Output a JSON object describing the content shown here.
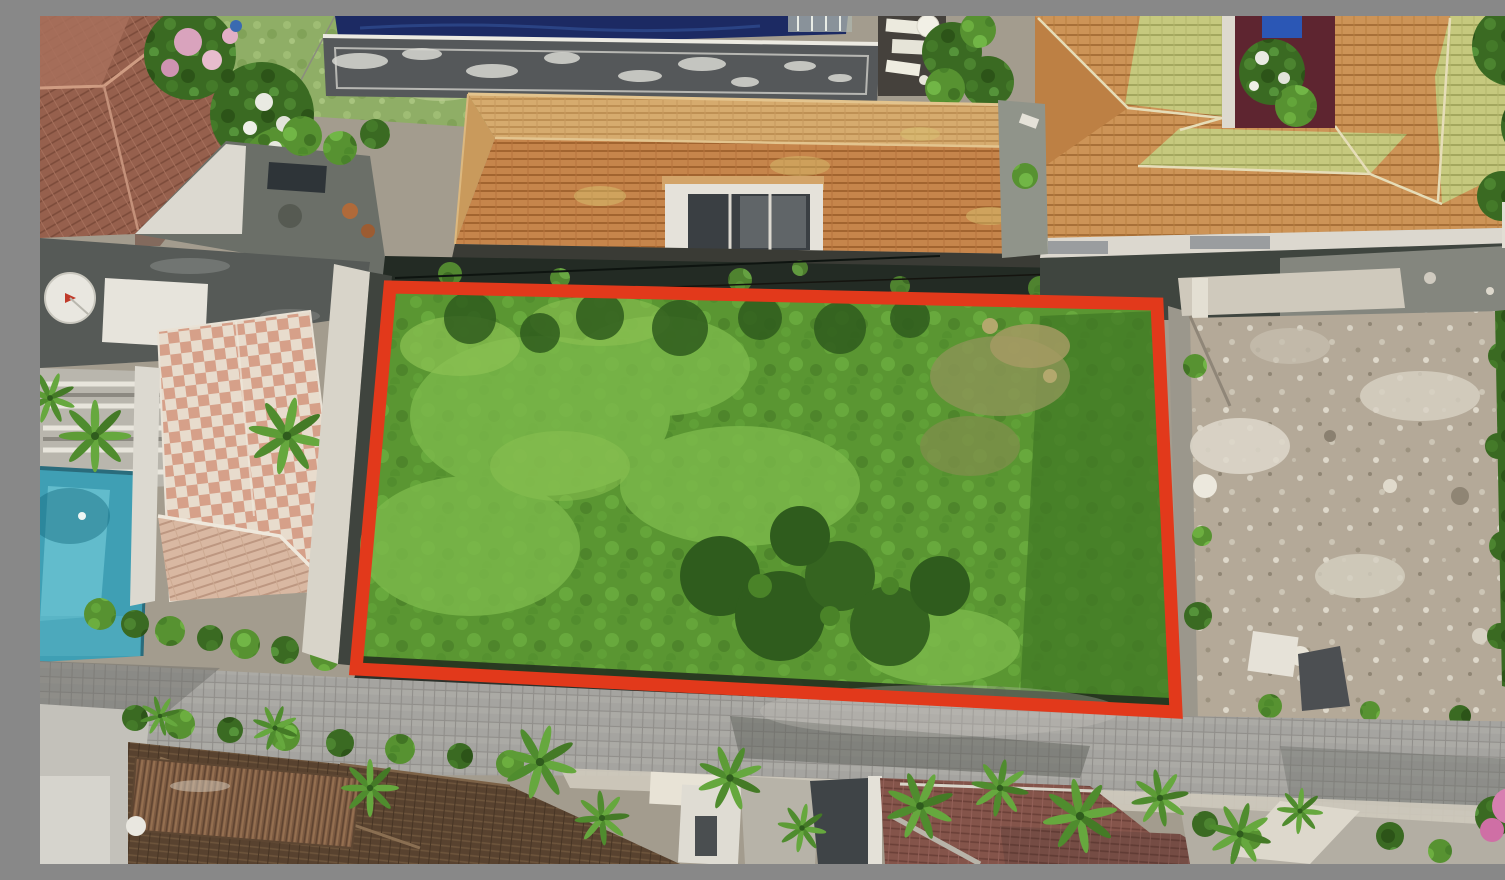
{
  "scene": {
    "description": "Aerial drone photo of a vacant overgrown land plot outlined with a red-orange boundary rectangle, bordered by tiled villa rooftops above, a villa compound with swimming pool on the left, an empty rubble dirt lot on the right, and a gray paver lane with palm-lined villas below",
    "plot_outline": {
      "shape": "quadrilateral",
      "color": "#e2391b"
    }
  },
  "colors": {
    "outline": "#e2391b",
    "plot_green": "#5d9a33",
    "plot_green_bright": "#7cb94b",
    "roof_orange": "#c6854b",
    "roof_tan": "#d6ab6e",
    "roof_lime": "#c6c97e",
    "roof_checker_pink": "#d6a089",
    "roof_checker_cream": "#e8dccd",
    "roof_brown_dark": "#58422f",
    "roof_red_brown": "#84544a",
    "pool_navy": "#1c2a63",
    "pool_turquoise": "#3f9fb4",
    "road_gray": "#a3a29e",
    "dirt_tan": "#b4a998",
    "flat_roof_charcoal": "#565a57",
    "courtyard_maroon": "#5e2530"
  }
}
